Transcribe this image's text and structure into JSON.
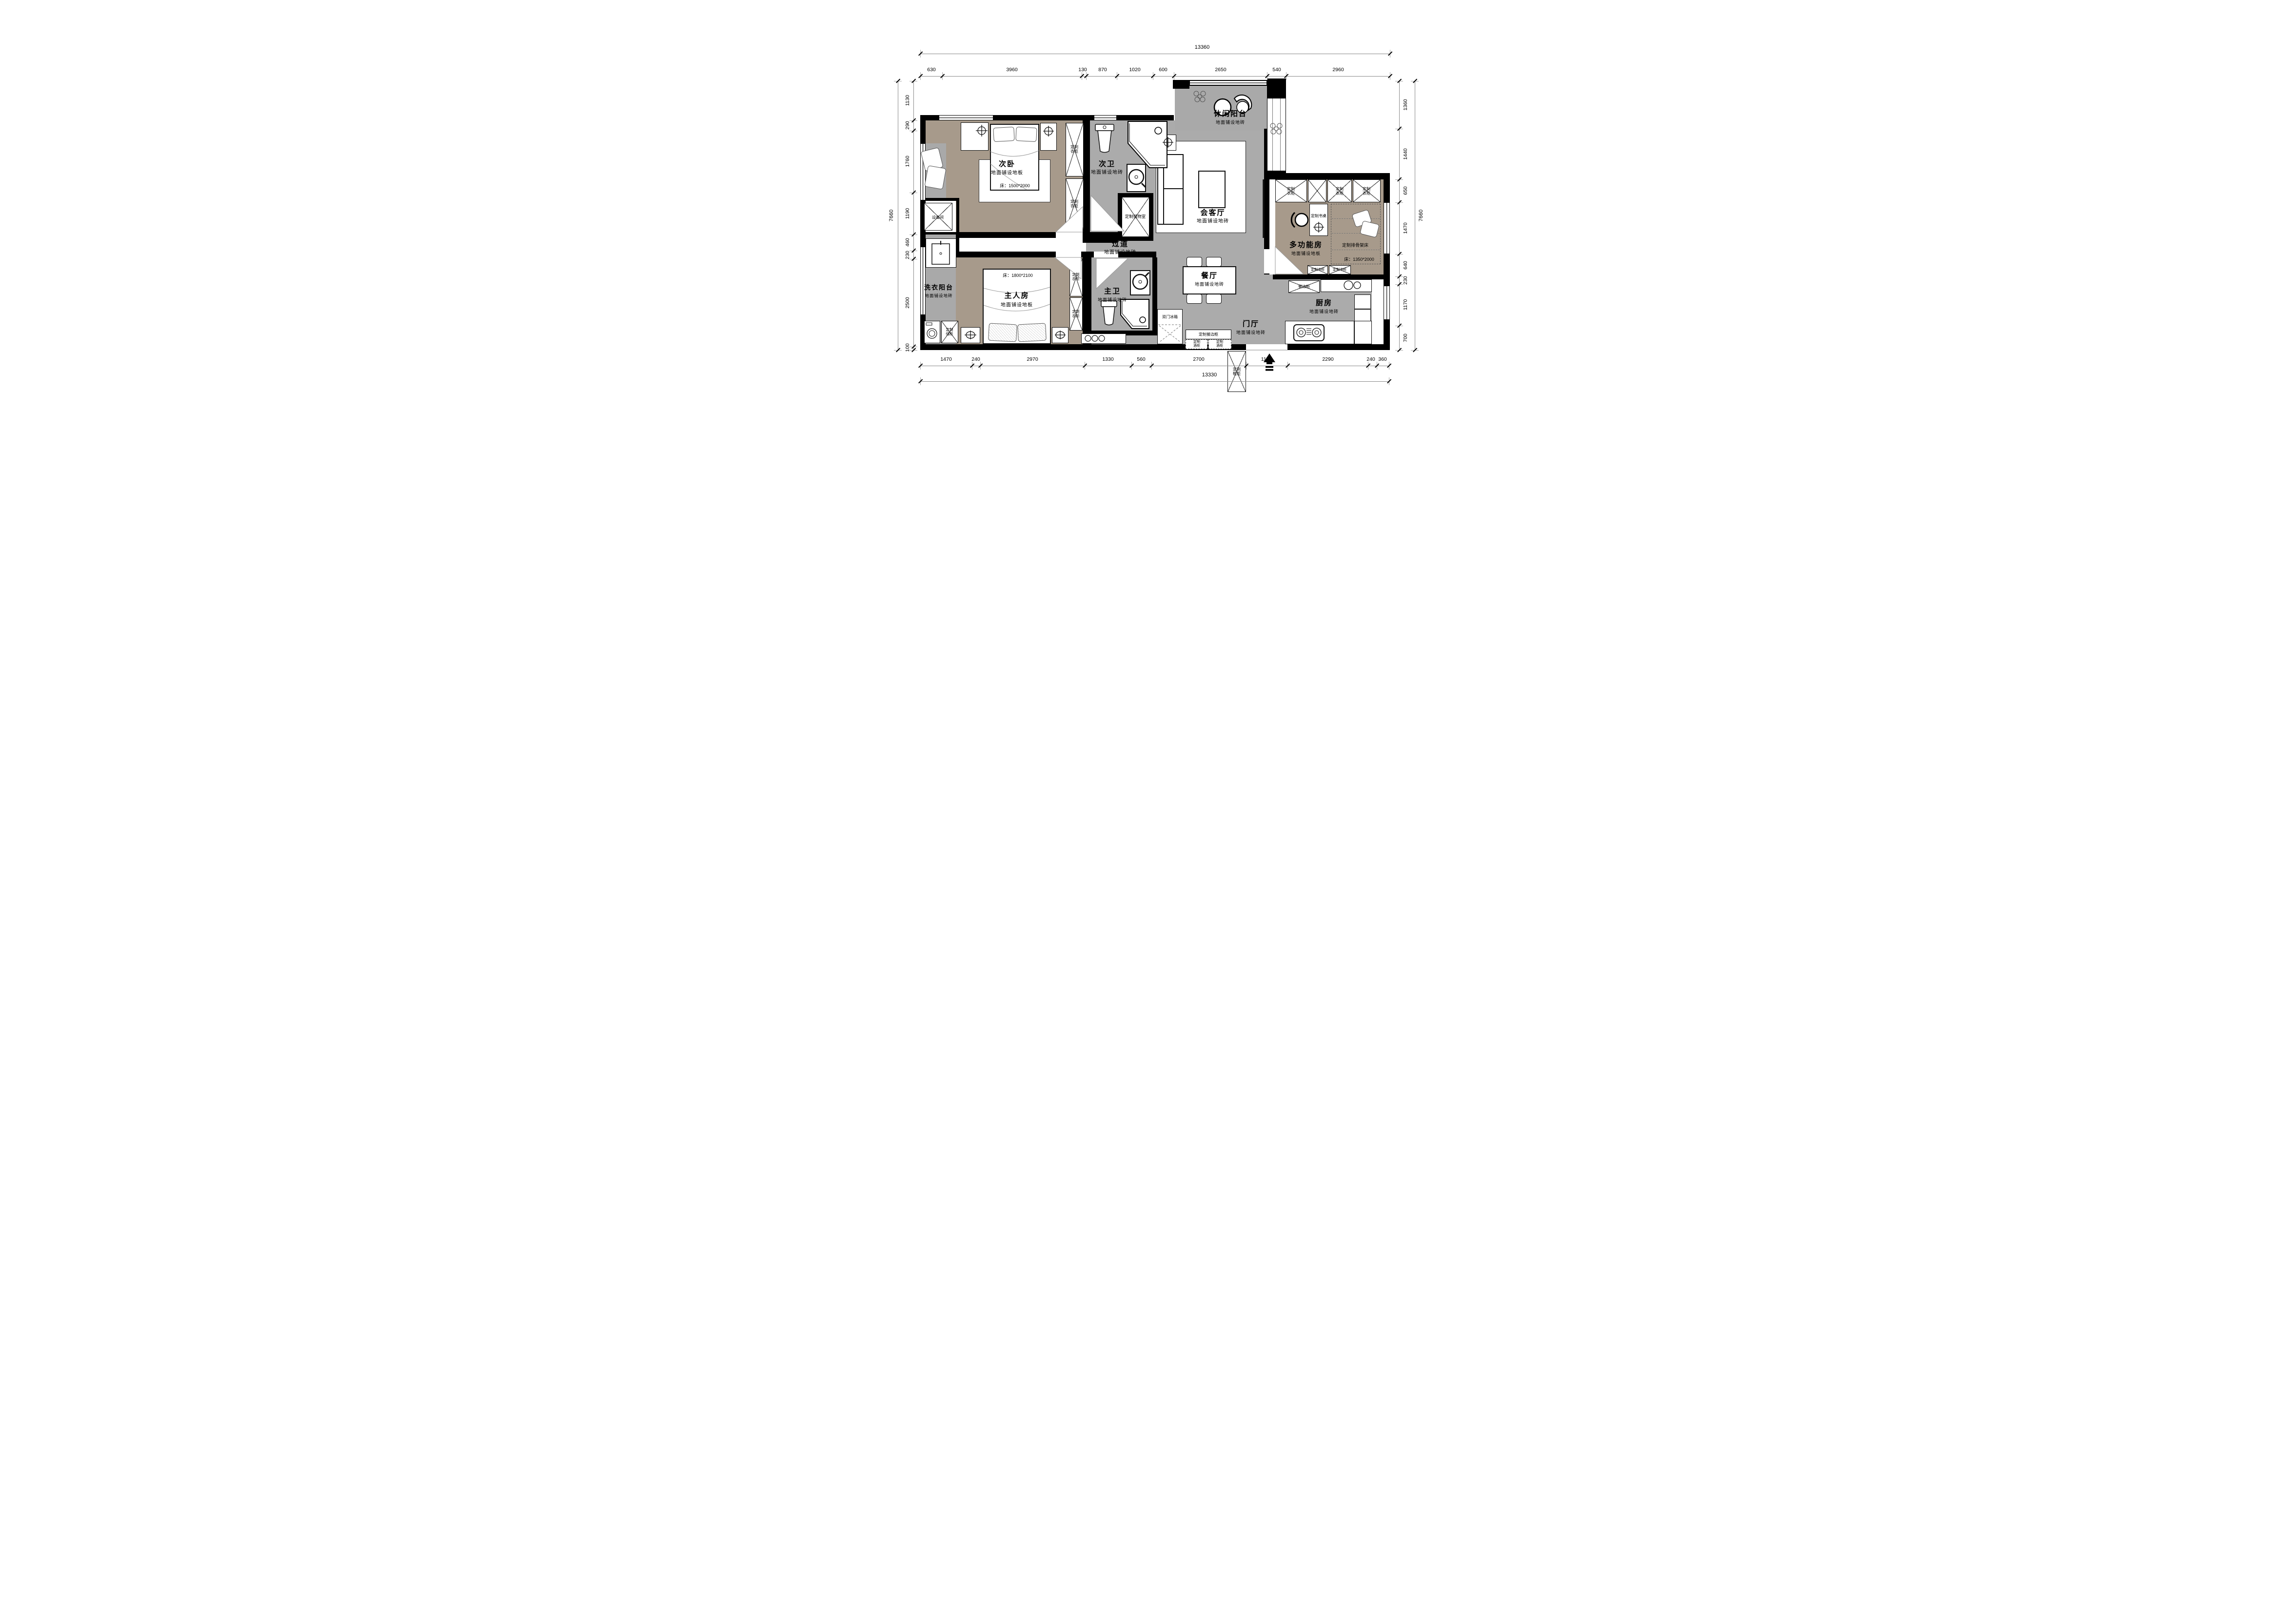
{
  "colors": {
    "wall": "#000000",
    "tile_gray": "#ababab",
    "balcony_gray": "#a9a9a9",
    "wood_taupe": "#a79a8b",
    "furniture_line": "#111111"
  },
  "dims": {
    "top": {
      "total": "13360",
      "segments": [
        "630",
        "3960",
        "130",
        "870",
        "1020",
        "600",
        "2650",
        "540",
        "2960"
      ]
    },
    "bottom": {
      "total": "13330",
      "segments": [
        "1470",
        "240",
        "2970",
        "1330",
        "560",
        "2700",
        "1170",
        "2290",
        "240",
        "360"
      ]
    },
    "left": {
      "total": "7660",
      "segments": [
        "1130",
        "290",
        "1760",
        "1190",
        "460",
        "230",
        "2500",
        "100"
      ]
    },
    "right": {
      "total": "7660",
      "segments": [
        "1360",
        "1440",
        "650",
        "1470",
        "640",
        "230",
        "1170",
        "700"
      ]
    }
  },
  "rooms": {
    "secondary_bedroom": {
      "name": "次卧",
      "floor": "地面铺设地板",
      "bed": "床：1500*2000"
    },
    "secondary_bath": {
      "name": "次卫",
      "floor": "地面铺设地砖"
    },
    "leisure_balcony": {
      "name": "休闲阳台",
      "floor": "地面铺设地砖"
    },
    "living": {
      "name": "会客厅",
      "floor": "地面铺设地砖"
    },
    "hallway": {
      "name": "过道",
      "floor": "地面铺设地砖"
    },
    "multi_room": {
      "name": "多功能房",
      "floor": "地面铺设地板",
      "bed_label": "定制排骨架床",
      "bed": "床：1350*2000",
      "desk": "定制书桌"
    },
    "master_bedroom": {
      "name": "主人房",
      "floor": "地面铺设地板",
      "bed": "床：1800*2100"
    },
    "master_bath": {
      "name": "主卫",
      "floor": "地面铺设地砖"
    },
    "laundry_balcony": {
      "name": "洗衣阳台",
      "floor": "地面铺设地砖"
    },
    "dining": {
      "name": "餐厅",
      "floor": "地面铺设地砖"
    },
    "kitchen": {
      "name": "厨房",
      "floor": "地面铺设地砖"
    },
    "entry": {
      "name": "门厅",
      "floor": "地面铺设地砖"
    },
    "equipment": {
      "name": "设备间"
    },
    "storage_room": {
      "name": "定制储物室"
    }
  },
  "cabinets": {
    "wardrobe": "定制衣柜",
    "storage_cabinet": "定制储柜",
    "bookcase": "定制书柜",
    "sideboard": "餐边柜",
    "custom_sideboard": "定制餐边柜",
    "wine_cabinet": "定制酒柜",
    "fridge": "双门冰箱",
    "shoe_cabinet": "定制鞋柜"
  }
}
